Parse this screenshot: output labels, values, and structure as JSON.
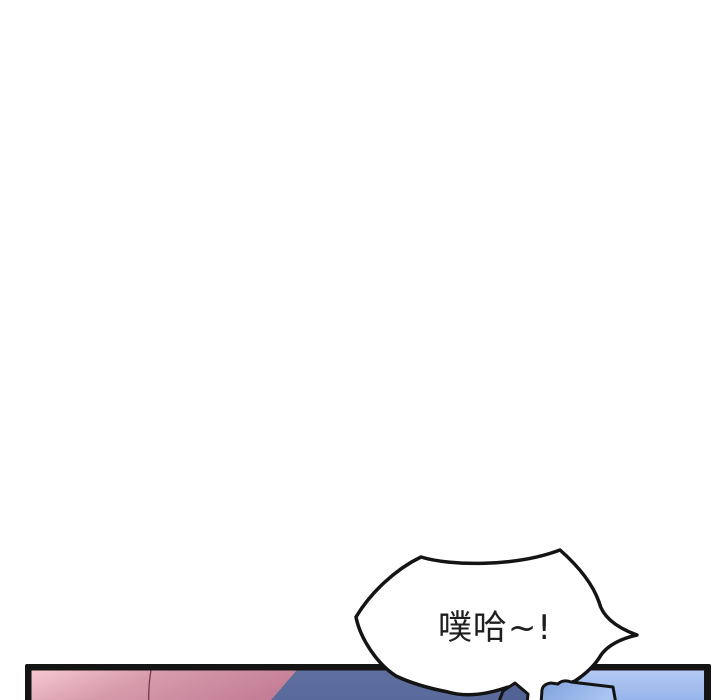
{
  "page": {
    "background": "#ffffff",
    "width": 720,
    "height": 700
  },
  "speech_bubble": {
    "text": "噗哈~!",
    "text_color": "#1f1f1f",
    "fill": "#ffffff",
    "stroke": "#141414"
  },
  "panel": {
    "border_color": "#141414",
    "colors": {
      "pink_light": "#f6c8d0",
      "pink_mid": "#d79bac",
      "pink_dark": "#c47f97",
      "contour": "#70394d",
      "slate_blue": "#57699a",
      "slate_deep": "#506394",
      "light_blue": "#8fb0ea",
      "light_blue_bright": "#b5c9f2",
      "cushion_blue": "#7fa2dd",
      "cushion_blue_bright": "#aac4f2"
    }
  }
}
